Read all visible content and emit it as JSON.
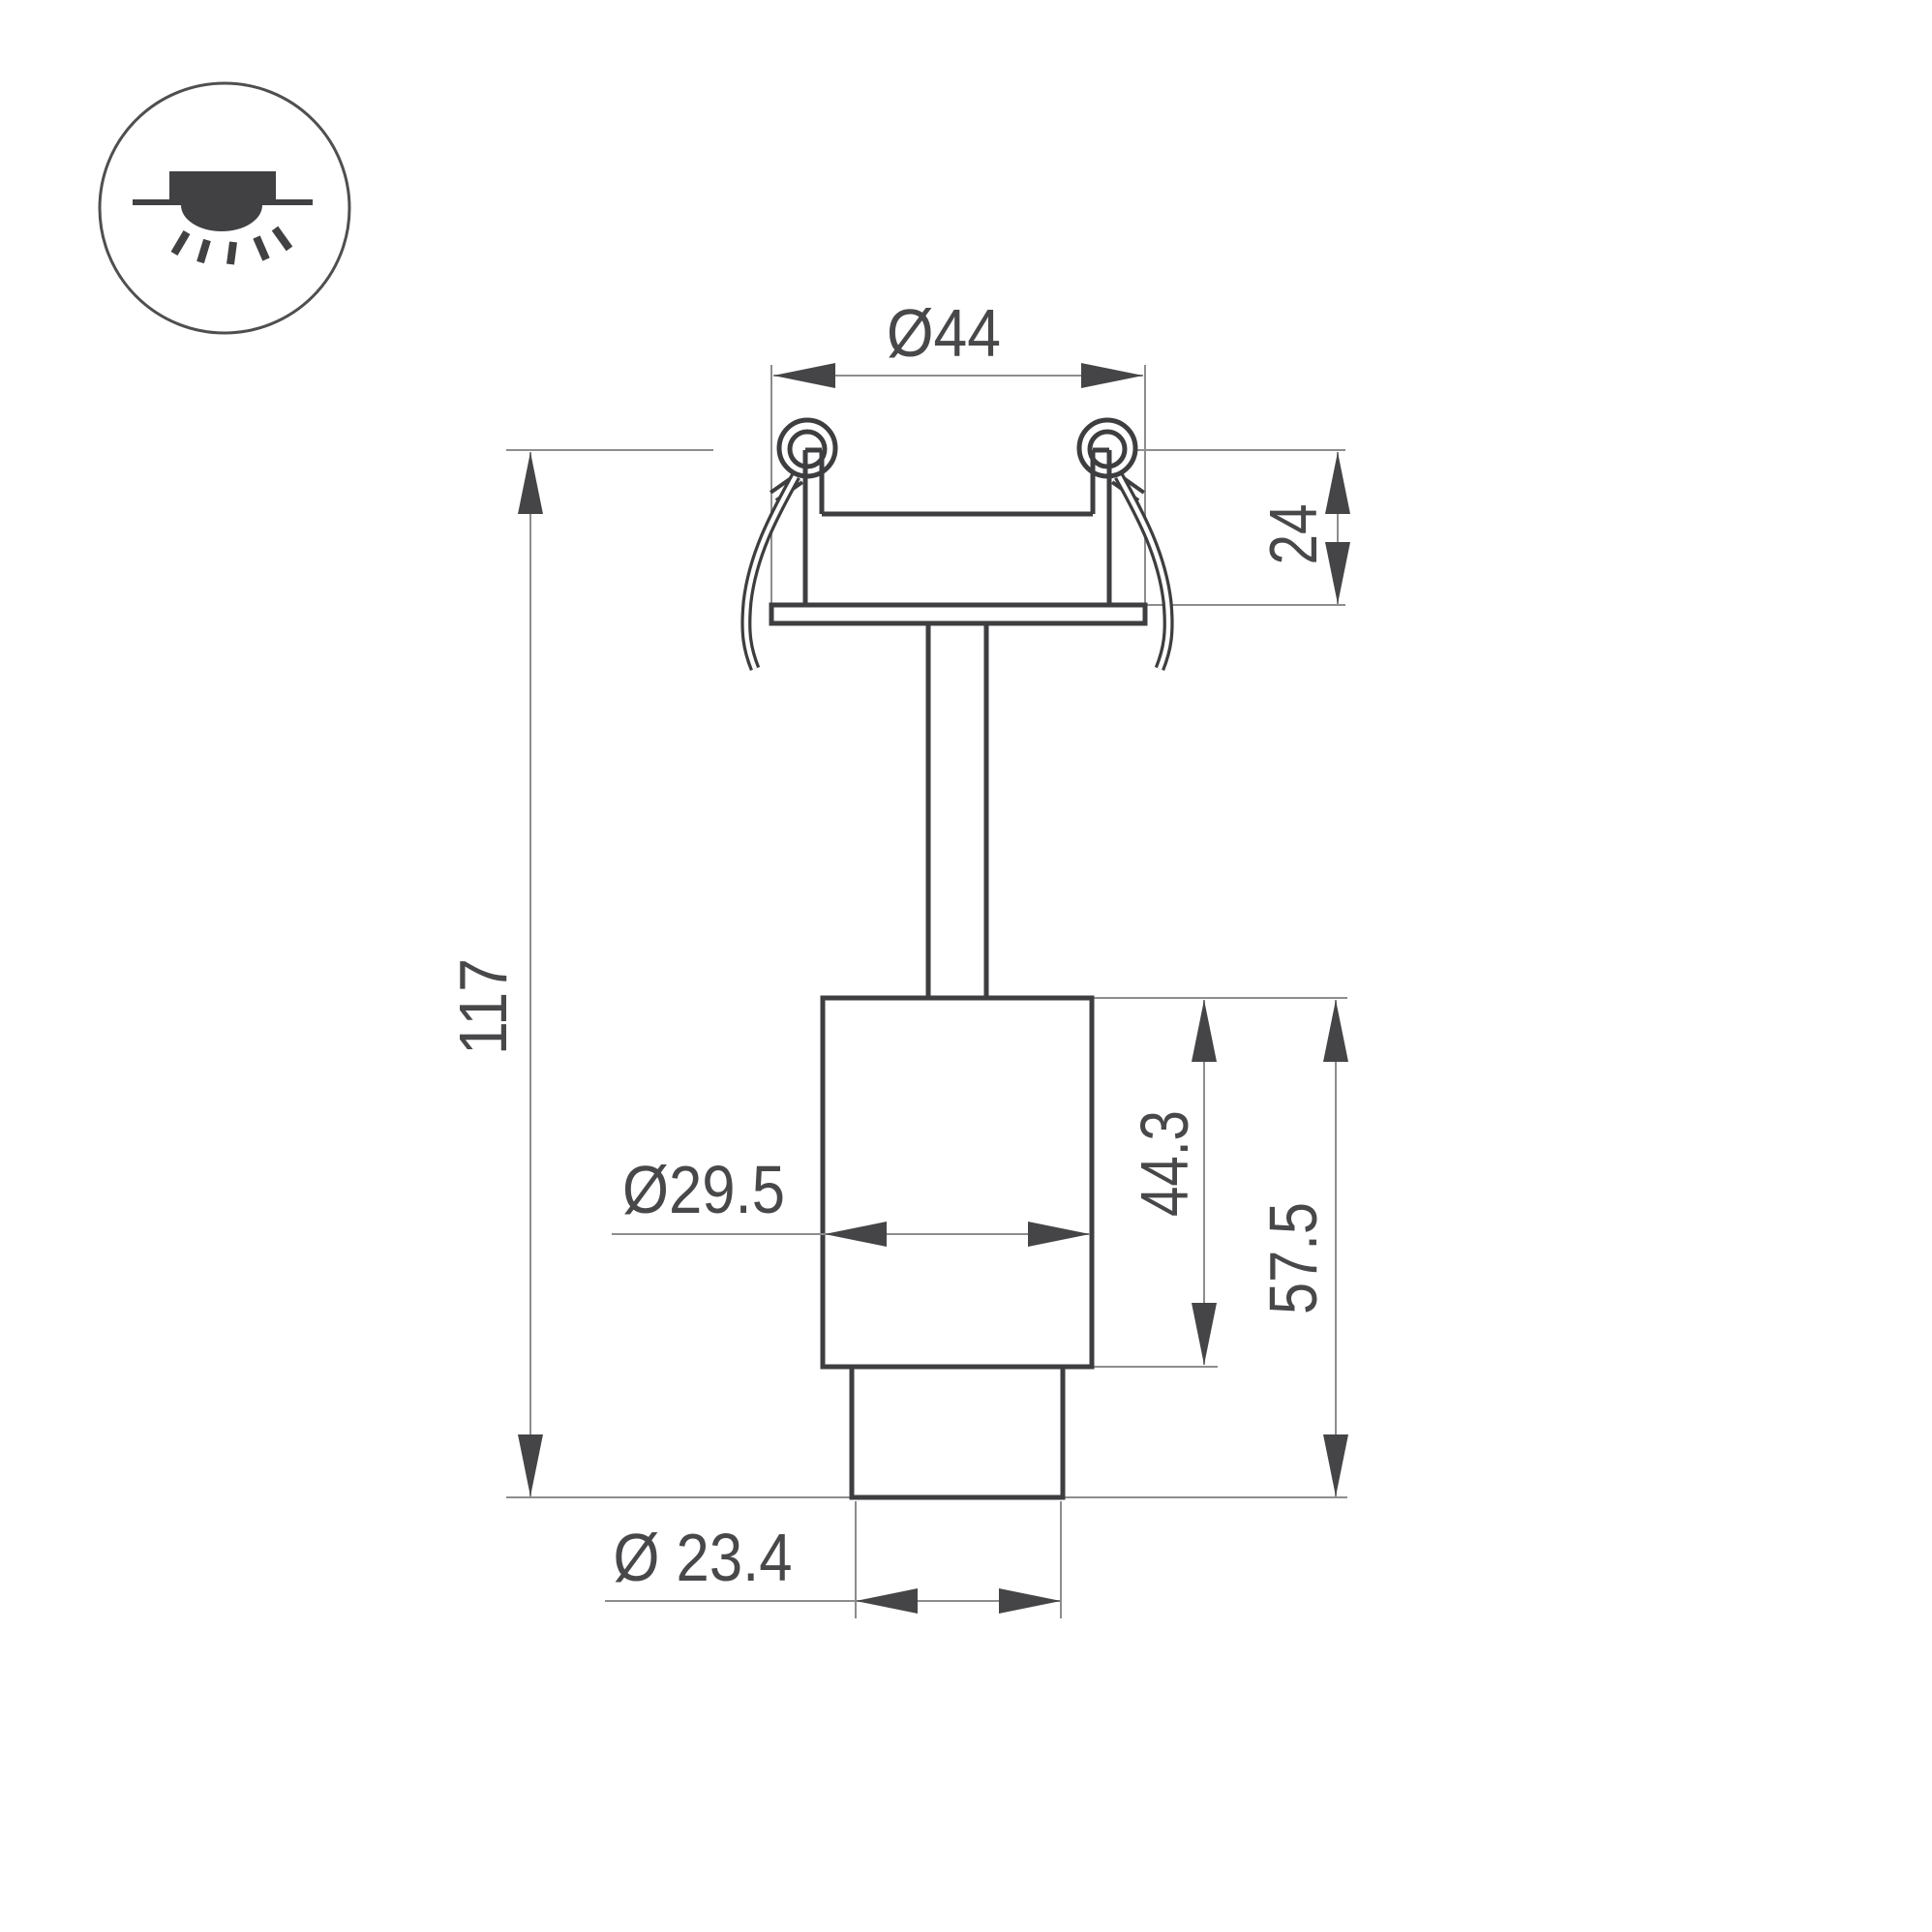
{
  "drawing": {
    "title": "recessed-spot-luminaire-dimension-drawing",
    "view": "front-section-view"
  },
  "icon": {
    "name": "recessed-downlight-mounting-icon"
  },
  "dimensions": {
    "top_diameter": "Ø44",
    "recess_depth": "24",
    "total_height": "117",
    "body_diameter": "Ø29.5",
    "body_height": "44.3",
    "lower_height": "57.5",
    "tip_diameter": "Ø 23.4"
  },
  "colors": {
    "background": "#ffffff",
    "object_line": "#3e3e40",
    "dimension_line": "#8d8d8f",
    "arrow_and_text": "#454547",
    "icon_fill": "#414143"
  }
}
